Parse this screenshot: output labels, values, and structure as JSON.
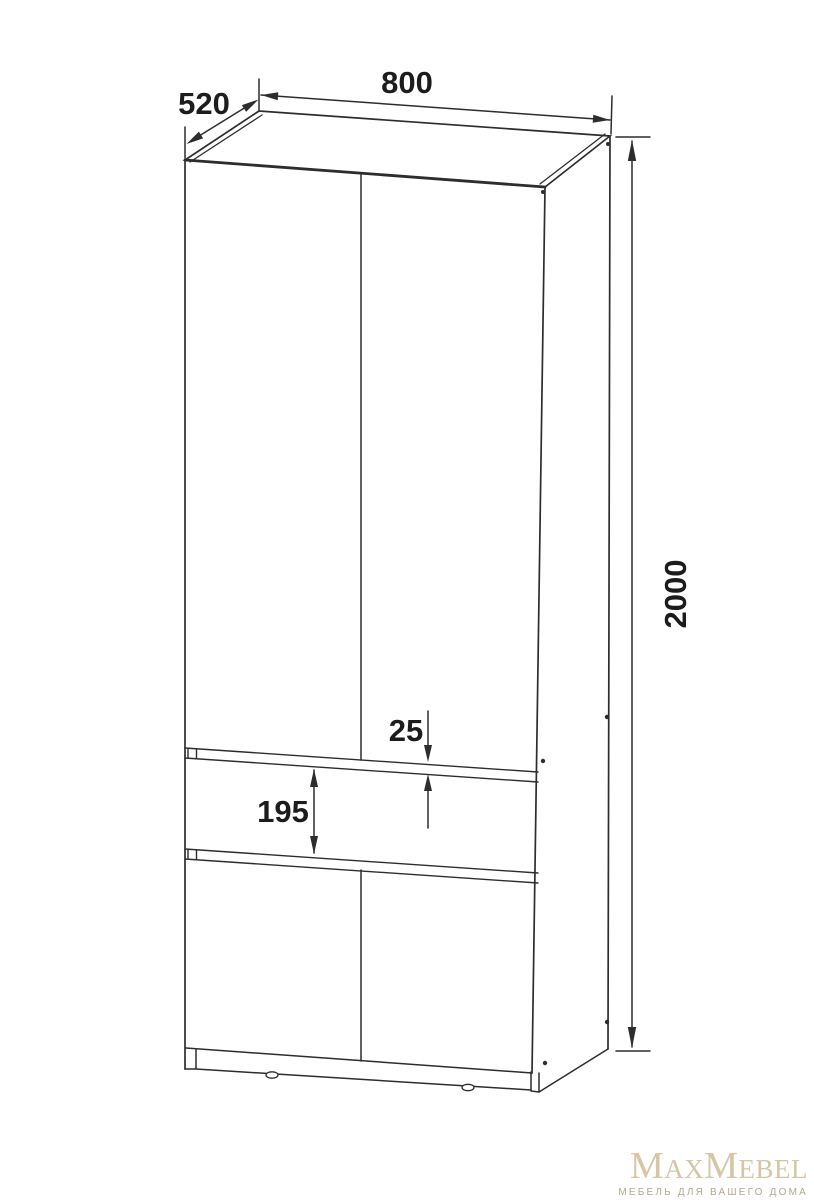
{
  "drawing": {
    "type": "furniture-technical-drawing",
    "subject": "two-door wardrobe with drawer",
    "background": "#ffffff",
    "line_color": "#2d2d2d",
    "label_color": "#1c1c1c",
    "dimension_labels": {
      "width": "800",
      "depth": "520",
      "height": "2000",
      "gap": "25",
      "drawer_front": "195"
    }
  },
  "logo": {
    "brand": "MaxMebel",
    "tagline": "МЕБЕЛЬ ДЛЯ ВАШЕГО ДОМА",
    "brand_color": "#d7c6a5",
    "tagline_color": "#b2a893"
  }
}
